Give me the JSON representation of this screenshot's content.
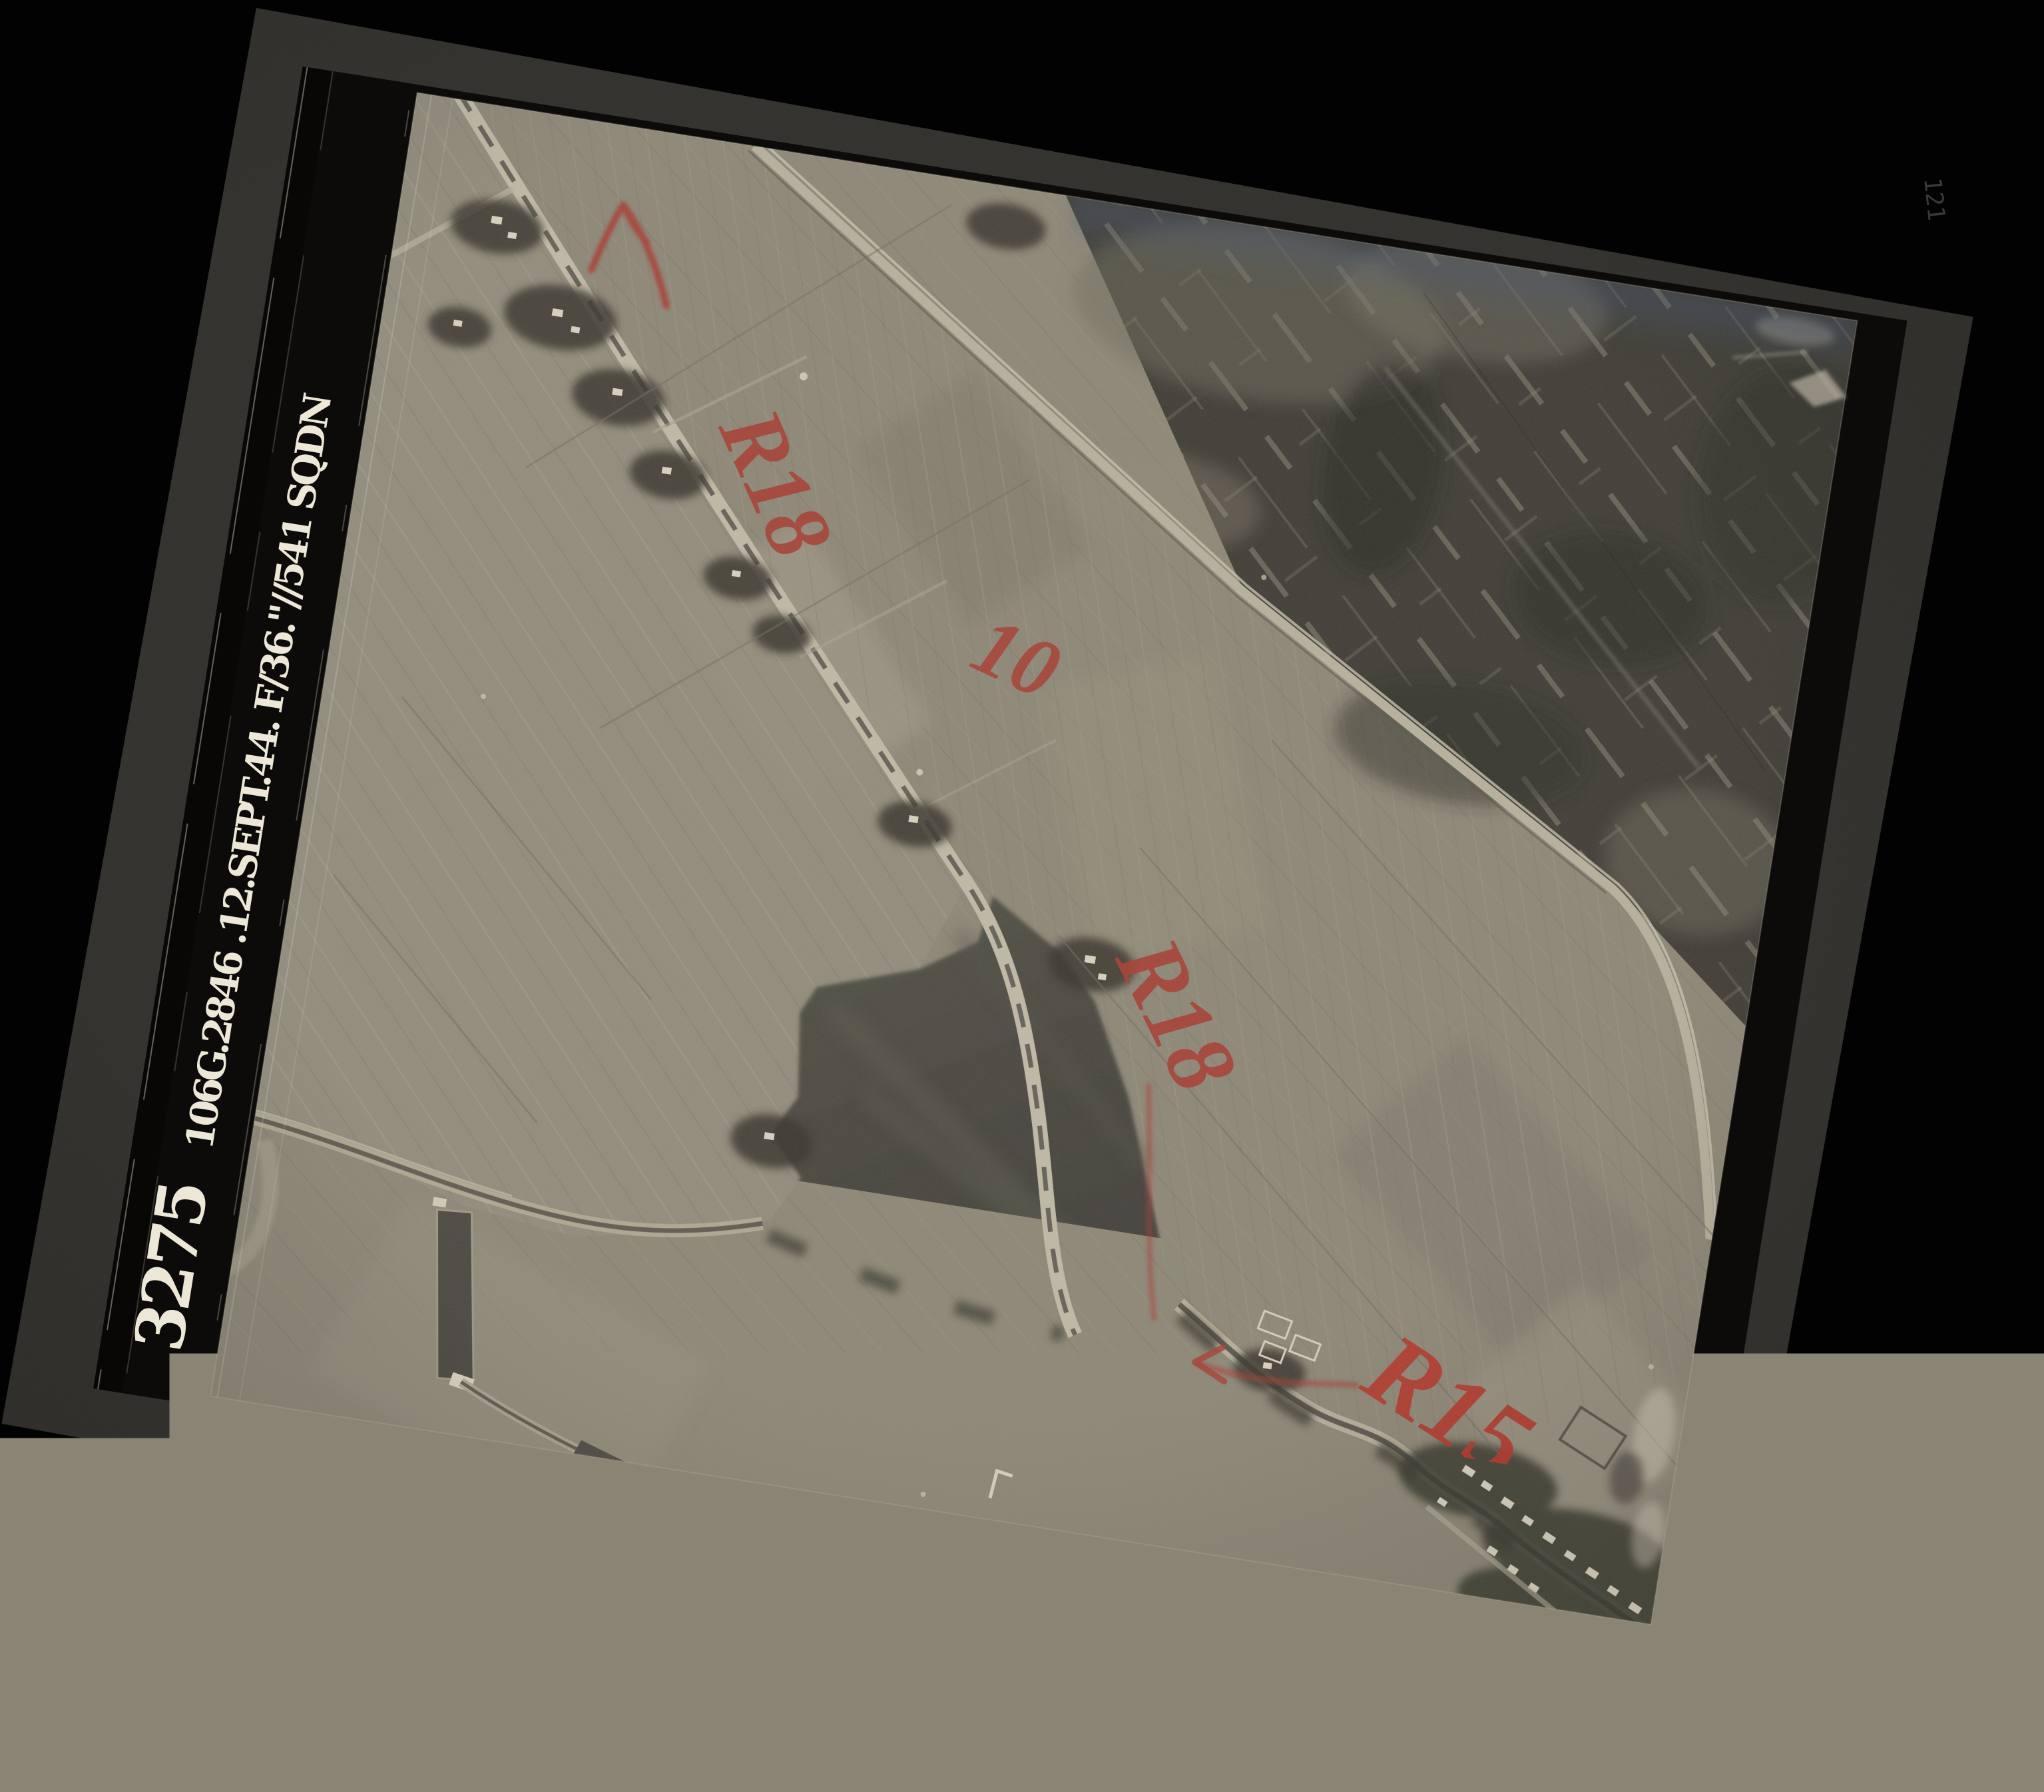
{
  "scene": {
    "type": "aerial-reconnaissance-photograph",
    "margin": {
      "print_number": "3275",
      "sortie_caption": "106G.2846 .12.SEPT.44. F/36.\"//541 SQDN"
    },
    "corner_mark": "121",
    "annotations": {
      "arrow_icon": "red-grease-arrow",
      "r18_upper": "R18",
      "field_number": "10",
      "r18_lower": "R18",
      "r15": "R15"
    },
    "colors": {
      "background": "#020202",
      "mount_board": "#2c2b28",
      "film_margin": "#0c0b09",
      "photo_base": "#8a8474",
      "lake_water": "#45433b",
      "dark_polder": "#3a3831",
      "red_grease": "#a5392d",
      "red_bright": "#b23327",
      "margin_text": "#ece7d6",
      "corner_mark_gray": "#4a4a4a"
    }
  }
}
